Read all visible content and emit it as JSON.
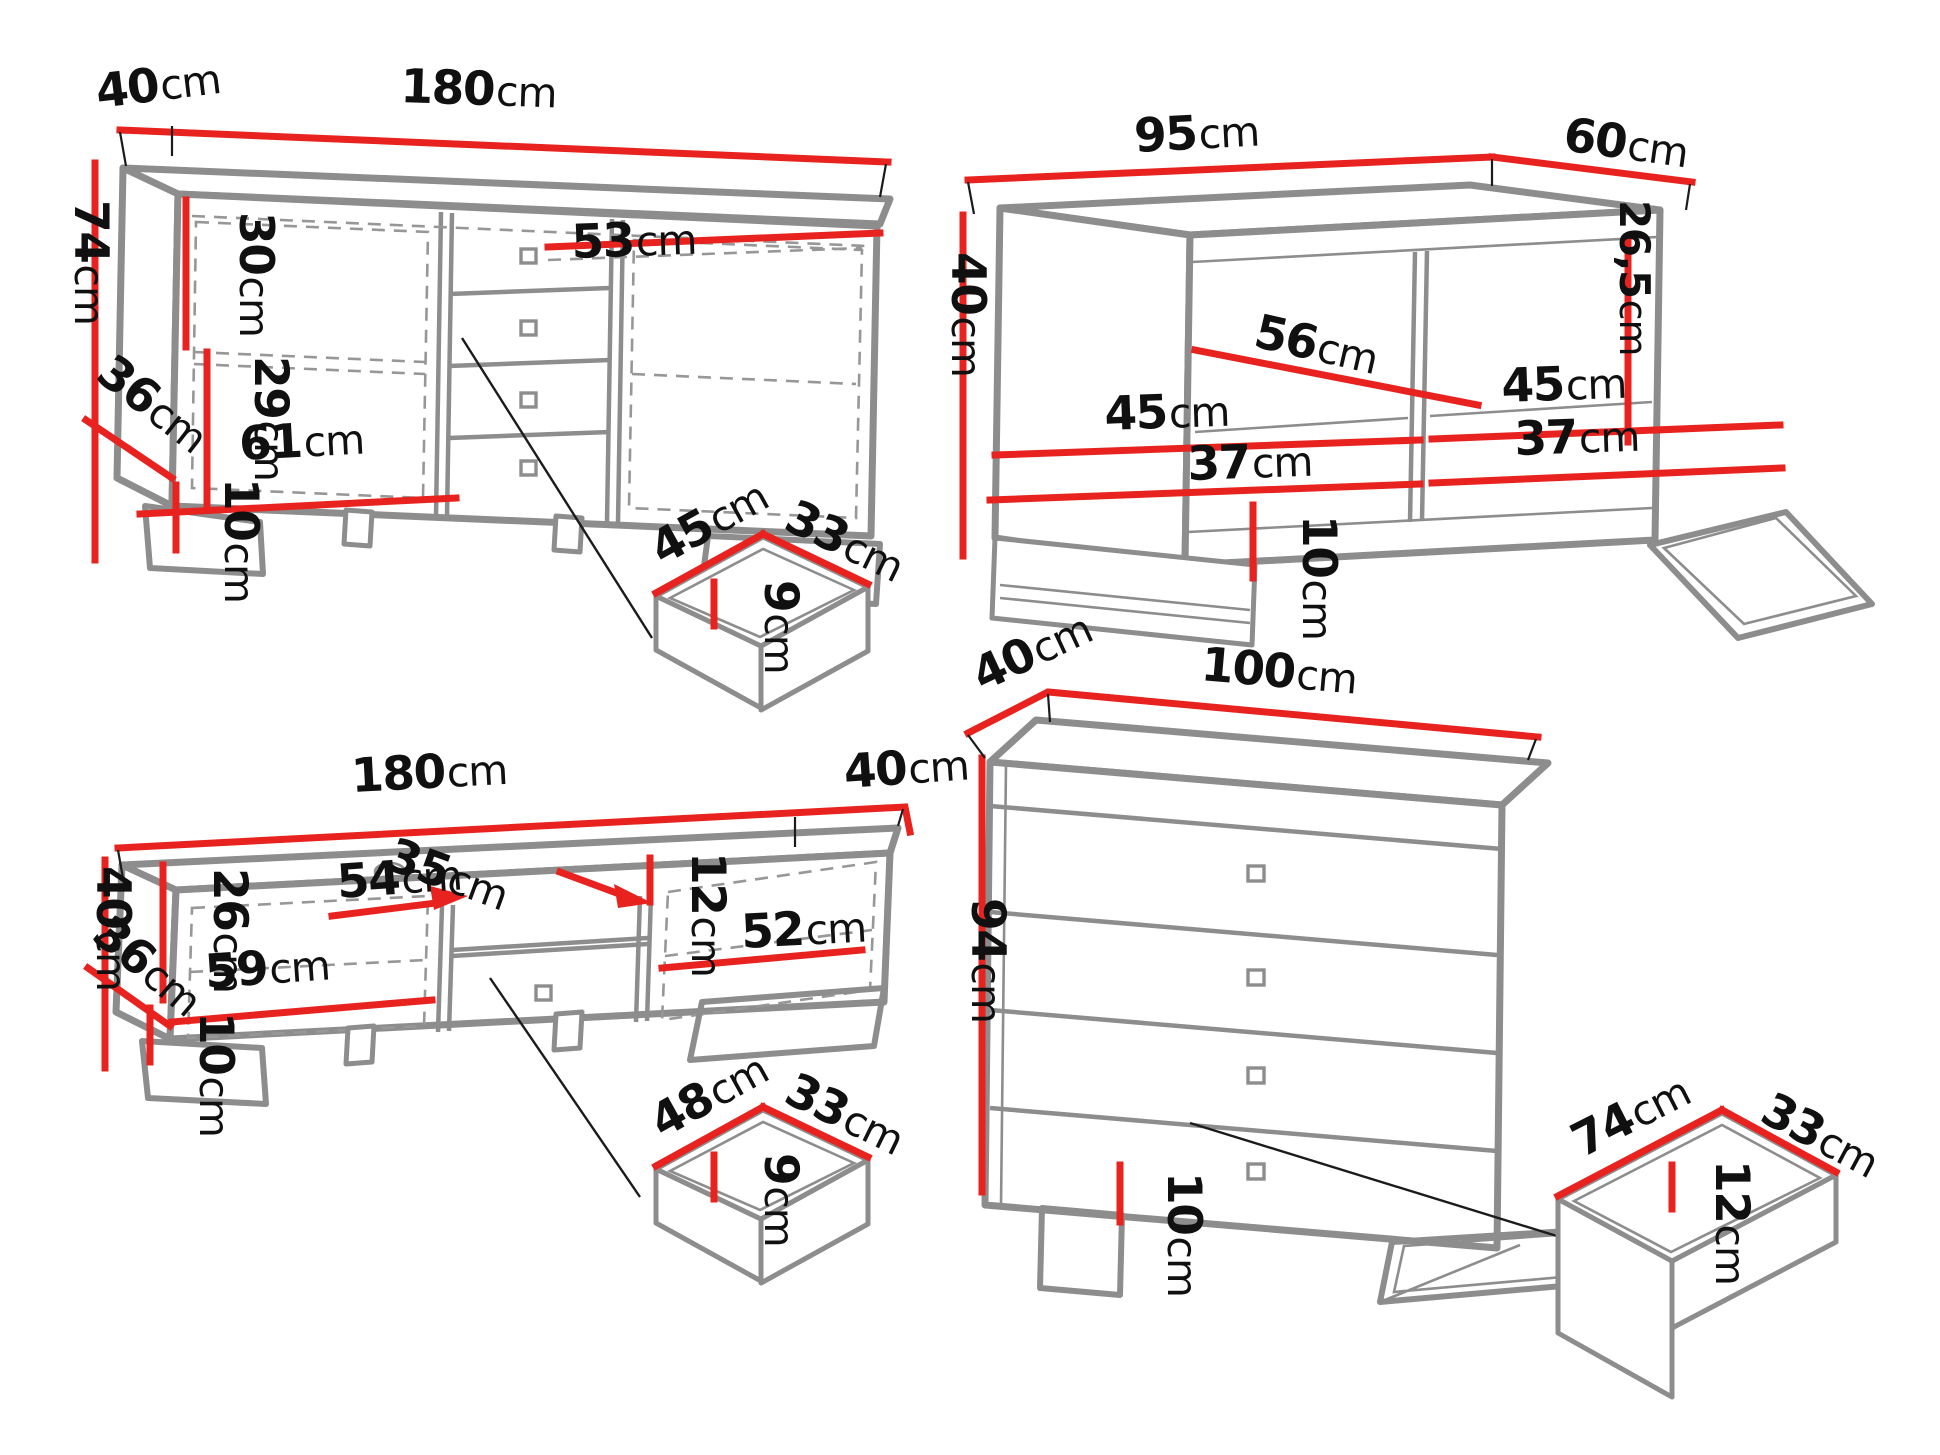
{
  "title": "furniture-dimensions-diagram",
  "colors": {
    "dimension": "#e8231f",
    "outline": "#8d8d8d",
    "text": "#101010",
    "background": "#ffffff"
  },
  "furniture": {
    "sideboard": {
      "name": "sideboard",
      "labels": {
        "depth": {
          "v": "40",
          "u": "cm"
        },
        "width": {
          "v": "180",
          "u": "cm"
        },
        "height": {
          "v": "74",
          "u": "cm"
        },
        "upper_inner_height": {
          "v": "30",
          "u": "cm"
        },
        "right_shelf_width": {
          "v": "53",
          "u": "cm"
        },
        "lower_inner_height": {
          "v": "29",
          "u": "cm"
        },
        "left_door_width": {
          "v": "61",
          "u": "cm"
        },
        "side_depth": {
          "v": "36",
          "u": "cm"
        },
        "leg_height": {
          "v": "10",
          "u": "cm"
        }
      }
    },
    "sideboard_drawer": {
      "name": "sideboard-drawer",
      "labels": {
        "width": {
          "v": "45",
          "u": "cm"
        },
        "depth": {
          "v": "33",
          "u": "cm"
        },
        "height": {
          "v": "9",
          "u": "cm"
        }
      }
    },
    "coffee_table": {
      "name": "coffee-table",
      "labels": {
        "width": {
          "v": "95",
          "u": "cm"
        },
        "depth": {
          "v": "60",
          "u": "cm"
        },
        "height": {
          "v": "40",
          "u": "cm"
        },
        "inner_height": {
          "v": "26,5",
          "u": "cm"
        },
        "left_diagonal": {
          "v": "56",
          "u": "cm"
        },
        "left_inner_width": {
          "v": "45",
          "u": "cm"
        },
        "left_inner_depth": {
          "v": "37",
          "u": "cm"
        },
        "right_inner_width": {
          "v": "45",
          "u": "cm"
        },
        "right_inner_depth": {
          "v": "37",
          "u": "cm"
        },
        "leg_height": {
          "v": "10",
          "u": "cm"
        }
      }
    },
    "tv_stand": {
      "name": "tv-stand",
      "labels": {
        "width": {
          "v": "180",
          "u": "cm"
        },
        "depth": {
          "v": "40",
          "u": "cm"
        },
        "height": {
          "v": "40",
          "u": "cm"
        },
        "side_depth": {
          "v": "36",
          "u": "cm"
        },
        "inner_height": {
          "v": "26",
          "u": "cm"
        },
        "left_door_width": {
          "v": "59",
          "u": "cm"
        },
        "leg_height": {
          "v": "10",
          "u": "cm"
        },
        "shelf_width": {
          "v": "54",
          "u": "cm"
        },
        "shelf_depth": {
          "v": "35",
          "u": "cm"
        },
        "shelf_height": {
          "v": "12",
          "u": "cm"
        },
        "right_door_width": {
          "v": "52",
          "u": "cm"
        }
      }
    },
    "tv_drawer": {
      "name": "tv-stand-drawer",
      "labels": {
        "width": {
          "v": "48",
          "u": "cm"
        },
        "depth": {
          "v": "33",
          "u": "cm"
        },
        "height": {
          "v": "9",
          "u": "cm"
        }
      }
    },
    "chest": {
      "name": "chest-of-drawers",
      "labels": {
        "depth": {
          "v": "40",
          "u": "cm"
        },
        "width": {
          "v": "100",
          "u": "cm"
        },
        "height": {
          "v": "94",
          "u": "cm"
        },
        "leg_height": {
          "v": "10",
          "u": "cm"
        }
      }
    },
    "chest_drawer": {
      "name": "chest-drawer",
      "labels": {
        "width": {
          "v": "74",
          "u": "cm"
        },
        "depth": {
          "v": "33",
          "u": "cm"
        },
        "height": {
          "v": "12",
          "u": "cm"
        }
      }
    }
  }
}
